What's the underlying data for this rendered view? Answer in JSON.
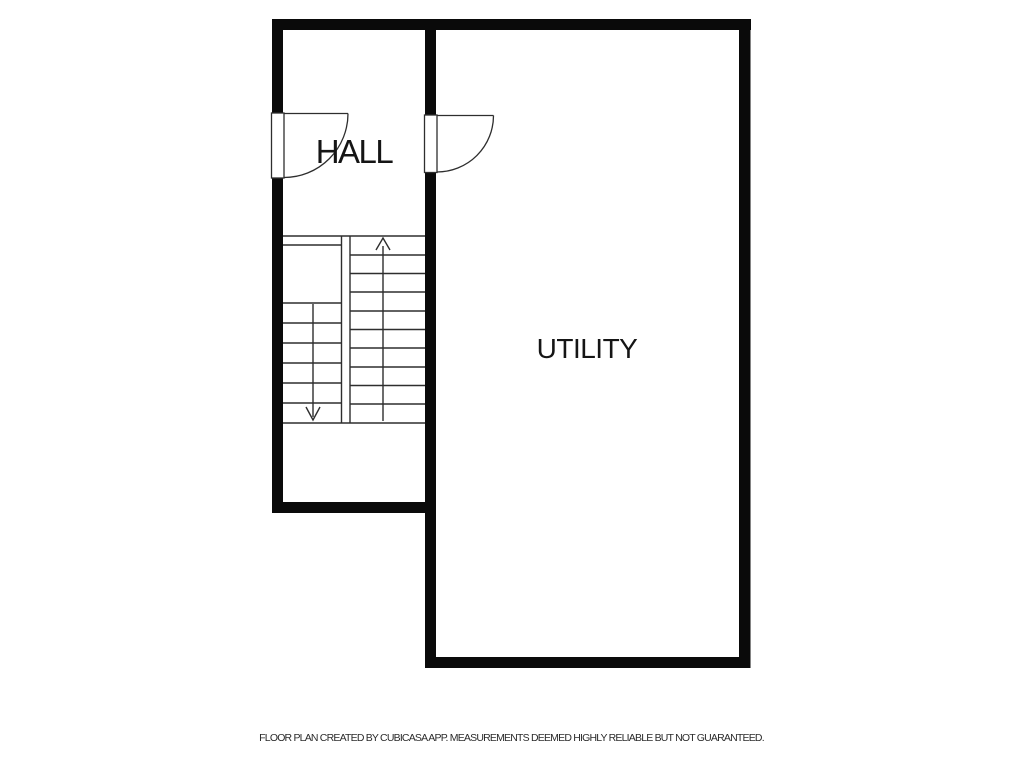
{
  "floor_plan": {
    "type": "floorplan",
    "source_app": "CubiCasa",
    "rooms": [
      {
        "label": "HALL"
      },
      {
        "label": "UTILITY"
      }
    ],
    "doors": {
      "count": 2,
      "items": [
        {
          "name": "hall-entry-door",
          "wall": "left",
          "swing": "quarter-arc"
        },
        {
          "name": "utility-door",
          "wall": "middle",
          "swing": "quarter-arc"
        }
      ]
    },
    "stairs": {
      "up_flight_steps": 10,
      "down_flight_steps": 6,
      "icons": [
        "up-arrow-icon",
        "down-arrow-icon"
      ]
    },
    "colors": {
      "wall": "#0a0a0a",
      "thin_line": "#2e2e2e",
      "room_label": "#151515",
      "footer_text": "#2b2b2b",
      "background": "#ffffff"
    }
  },
  "footer": {
    "disclaimer": "FLOOR PLAN CREATED BY CUBICASA APP. MEASUREMENTS DEEMED HIGHLY RELIABLE BUT NOT GUARANTEED."
  }
}
